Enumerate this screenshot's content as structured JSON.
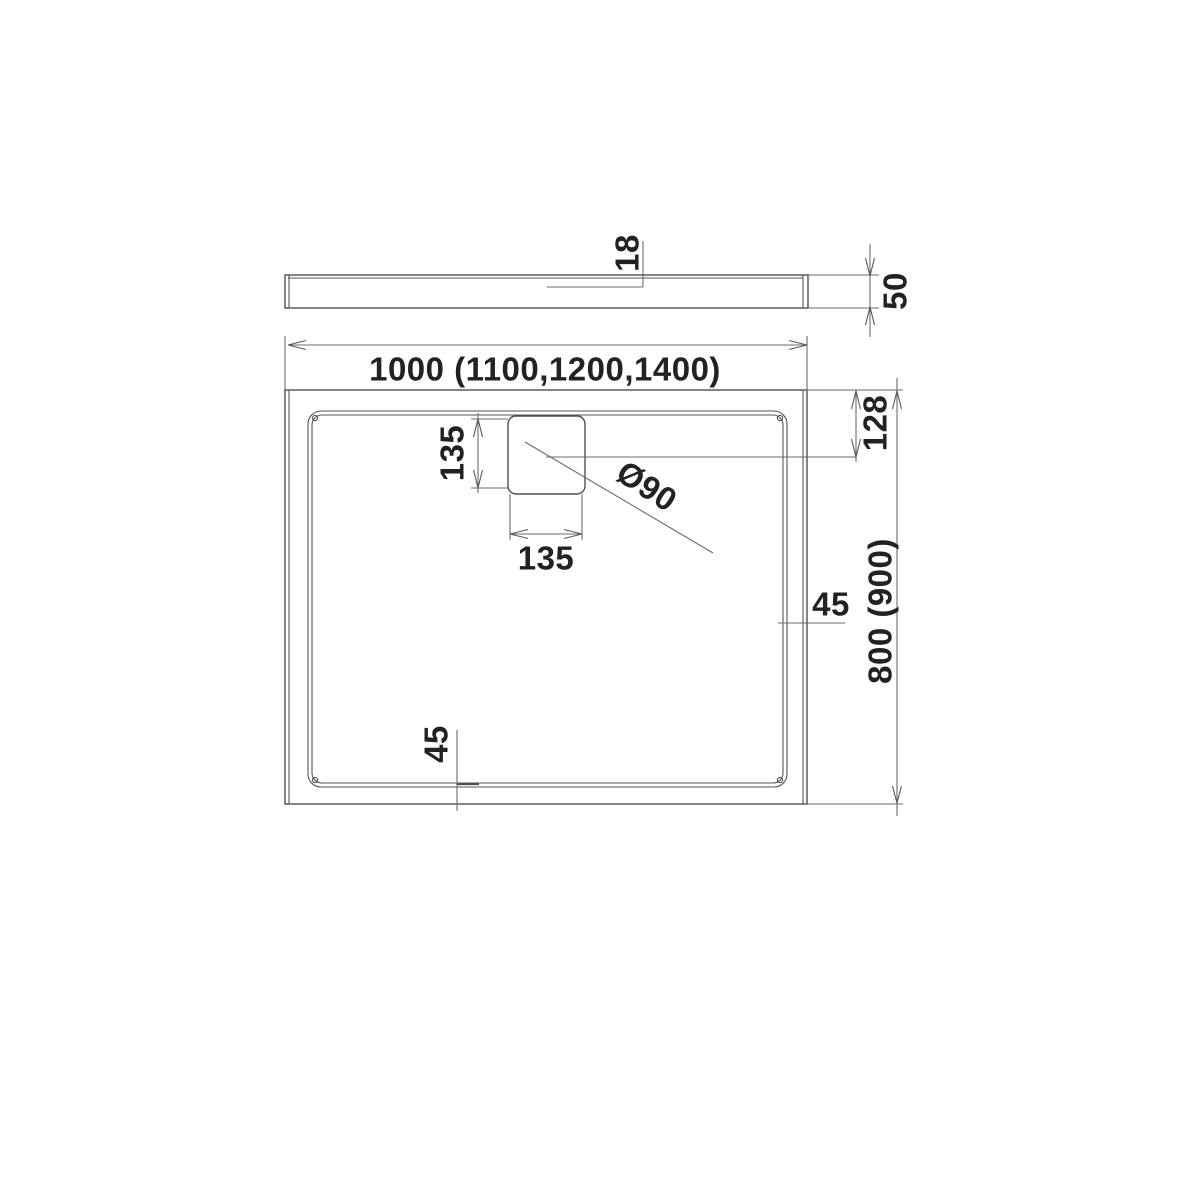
{
  "side_view": {
    "rim_thickness": "18",
    "total_height": "50"
  },
  "plan_view": {
    "width": "1000 (1100,1200,1400)",
    "depth": "800 (900)",
    "drain_center_from_top": "128",
    "drain_square_height": "135",
    "drain_square_width": "135",
    "drain_diameter": "Ø90",
    "rim_width_right": "45",
    "rim_width_bottom": "45"
  }
}
